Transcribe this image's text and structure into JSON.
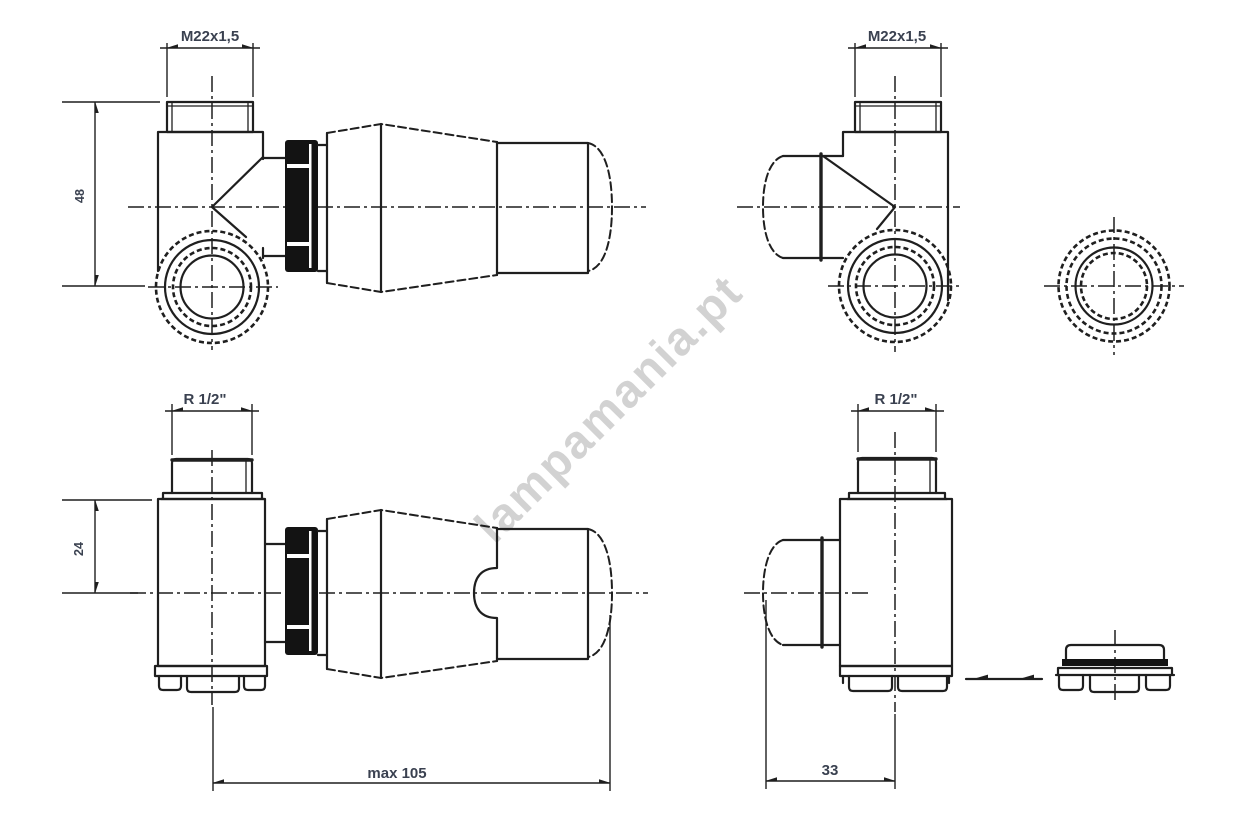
{
  "watermark": "lampamania.pt",
  "colors": {
    "line": "#1f1f1f",
    "dim_text": "#3a4150",
    "watermark": "#c8c8c8",
    "background": "#ffffff"
  },
  "views": {
    "top_left": {
      "name": "corner valve side view with thermostatic head",
      "dim_thread": "M22x1,5",
      "dim_height": "48"
    },
    "top_right": {
      "name": "corner valve opposite side view",
      "dim_thread": "M22x1,5"
    },
    "ring_front": {
      "name": "connection ring front view"
    },
    "bottom_left": {
      "name": "straight valve side view with thermostatic head",
      "dim_thread": "R 1/2\"",
      "dim_height": "24",
      "dim_length": "max 105"
    },
    "bottom_right": {
      "name": "straight valve opposite side view",
      "dim_thread": "R 1/2\"",
      "dim_width": "33"
    },
    "adapter_nut": {
      "name": "adapter nut side view"
    }
  }
}
